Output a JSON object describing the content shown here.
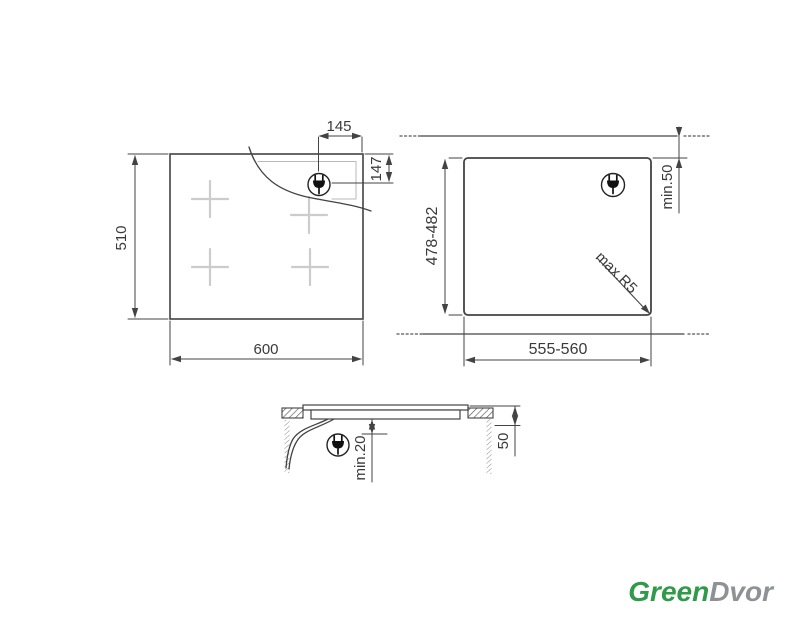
{
  "diagram": {
    "top_view": {
      "width": "600",
      "height": "510",
      "plug_offset_x": "145",
      "plug_offset_y": "147"
    },
    "cutout_view": {
      "width": "555-560",
      "height": "478-482",
      "rear_clearance": "min.50",
      "corner_radius": "max.R5"
    },
    "section_view": {
      "below_clearance": "min.20",
      "worktop_thickness": "50"
    }
  },
  "logo": {
    "green_text": "Green",
    "gray_text": "Dvor",
    "green_color": "#2f9b4a",
    "gray_color": "#8f9294"
  },
  "colors": {
    "line": "#434343",
    "light_marks": "#c9c9c9"
  }
}
